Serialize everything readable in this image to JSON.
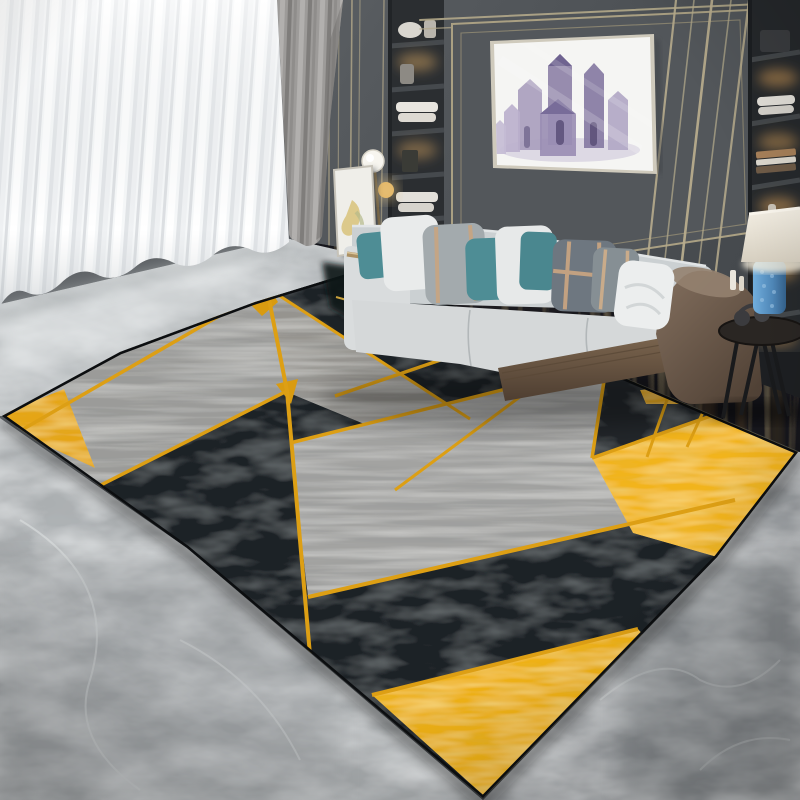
{
  "image": {
    "description": "Modern living room interior photo showcasing a black, grey and gold geometric area rug in front of a light grey sofa",
    "width": 800,
    "height": 800
  },
  "palette": {
    "wall": "#575b5f",
    "wall_dark": "#464a4e",
    "trim": "#b3a88a",
    "trim_bright": "#d6cba8",
    "curtain_sheer": "#f5f7f8",
    "curtain_gray": "#908e8c",
    "artwork_canvas": "#f5f5f3",
    "artwork_purple": "#8d81a6",
    "shelf_bg": "#2b2e31",
    "shelf_glow": "#d8a05a",
    "sofa_fabric": "#d5d8d9",
    "sofa_back": "#cbd0d2",
    "sofa_arm": "#d9dcdd",
    "sofa_wood": "#6e5a46",
    "sofa_brown": "#6f5d4e",
    "pillow_white": "#e9ebeb",
    "pillow_gray": "#a3aaad",
    "pillow_teal": "#4e8d95",
    "pillow_plaid": "#6e7780",
    "pillow_stripe": "#c2a181",
    "lamp_shade": "#eee8db",
    "lamp_blue": "#5b93c4",
    "table_dark": "#2a2623",
    "floor_dark": "#17191c",
    "marble": "#abafb1",
    "marble_light": "#b6babc",
    "rug_black": "#1e2427",
    "rug_gray": "#9b9b99",
    "rug_gold": "#dd9f14",
    "rug_gold_deep": "#d4950e",
    "rug_yellow": "#f2b41a",
    "rug_edge": "#0c0e10"
  },
  "scene": {
    "curtains": {
      "sheer": "white sheer curtain, vertical folds",
      "drape": "grey drape panel"
    },
    "wall": {
      "style": "dark grey panelled wall",
      "trim": "champagne metal trim lines"
    },
    "artwork": {
      "type": "framed print",
      "subject": "abstract watercolor houses in purple grey",
      "frame": "thin champagne frame"
    },
    "shelves": {
      "left": "recessed lit shelving with towels and vases",
      "right": "recessed lit shelving with books, towels and candles"
    },
    "floor_lamp": {
      "globe": "frosted white globe",
      "accent": "brass disc"
    },
    "leaning_frame": {
      "canvas": "white canvas with gold abstract brushwork"
    },
    "sofa": {
      "fabric": "light grey upholstery",
      "base": "walnut wood plinth",
      "right_side": "taupe leather wrap",
      "pillows": [
        "teal",
        "white",
        "grey with tan stripes",
        "teal",
        "white",
        "teal",
        "dark plaid with tan stripes",
        "grey plaid",
        "white crumpled"
      ]
    },
    "side_table": {
      "top": "round dark wood",
      "items": [
        "dark headphones"
      ],
      "legs": "black splayed legs"
    },
    "table_lamp": {
      "shade": "cream drum shade",
      "base": "textured blue ceramic"
    },
    "floor": {
      "material": "grey marble tile with white veining",
      "under_sofa": "dark reflective stone"
    },
    "rug": {
      "style": "modern geometric",
      "colors": [
        "black",
        "textured grey",
        "gold",
        "yellow"
      ],
      "elements": [
        "large black triangles",
        "scratched grey triangles",
        "thin golden dividing lines",
        "yellow triangle right",
        "yellow triangle bottom",
        "gold corner accent",
        "small gold crossing triangles"
      ],
      "border": "thin dark binding with floor shadow"
    }
  }
}
